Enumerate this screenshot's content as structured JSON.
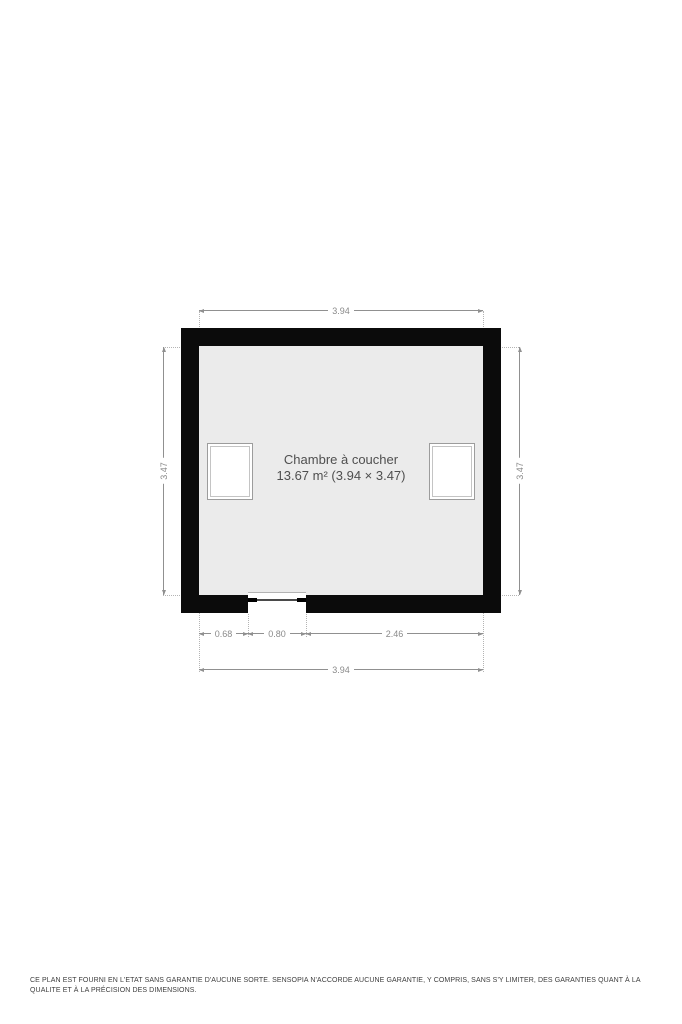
{
  "plan": {
    "room": {
      "name": "Chambre à coucher",
      "area": "13.67 m² (3.94 × 3.47)"
    },
    "dimensions": {
      "top": "3.94",
      "left": "3.47",
      "right": "3.47",
      "bottom_left": "0.68",
      "bottom_opening": "0.80",
      "bottom_right": "2.46",
      "bottom_total": "3.94"
    },
    "features": {
      "windows": [
        "roof-window-left",
        "roof-window-right"
      ],
      "opening_width": "0.80"
    },
    "colors": {
      "wall": "#0b0b0b",
      "floor": "#ebebeb",
      "dimension_line": "#909090",
      "dimension_text": "#8a8a8a",
      "room_text": "#4f4f4f"
    }
  },
  "footer": {
    "disclaimer": "CE PLAN EST FOURNI EN L'ETAT SANS GARANTIE D'AUCUNE SORTE. SENSOPIA N'ACCORDE AUCUNE GARANTIE, Y COMPRIS, SANS S'Y LIMITER, DES GARANTIES QUANT À LA QUALITE ET À LA PRÉCISION DES DIMENSIONS."
  }
}
